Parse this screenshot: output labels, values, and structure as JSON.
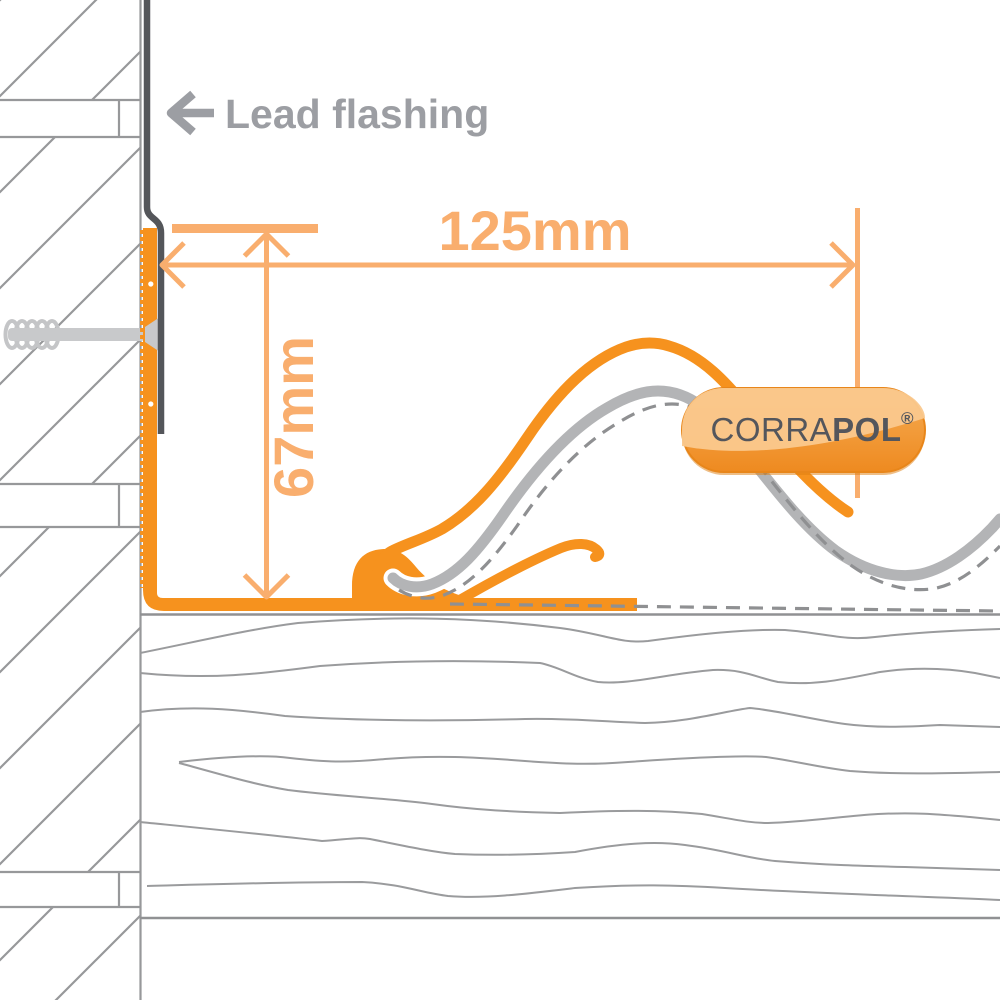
{
  "diagram": {
    "title": "Corrapol wall flashing installation detail",
    "labels": {
      "lead_flashing": "Lead flashing",
      "width_dimension": "125mm",
      "height_dimension": "67mm"
    },
    "badge": {
      "brand_regular": "CORRA",
      "brand_bold": "POL",
      "registered": "®"
    },
    "colors": {
      "flashing_orange": "#F6921E",
      "dimension_orange": "#F9AE6E",
      "badge_gradient_top": "#F6AD55",
      "badge_gradient_bottom": "#EE8A20",
      "badge_gloss": "#FAC88D",
      "badge_border": "#E8861A",
      "badge_text": "#54565C",
      "label_gray": "#9C9EA3",
      "sheet_gray": "#B3B4B6",
      "line_gray": "#97989A",
      "lead_gray": "#54565A",
      "screw_gray": "#C8C9CB"
    }
  }
}
